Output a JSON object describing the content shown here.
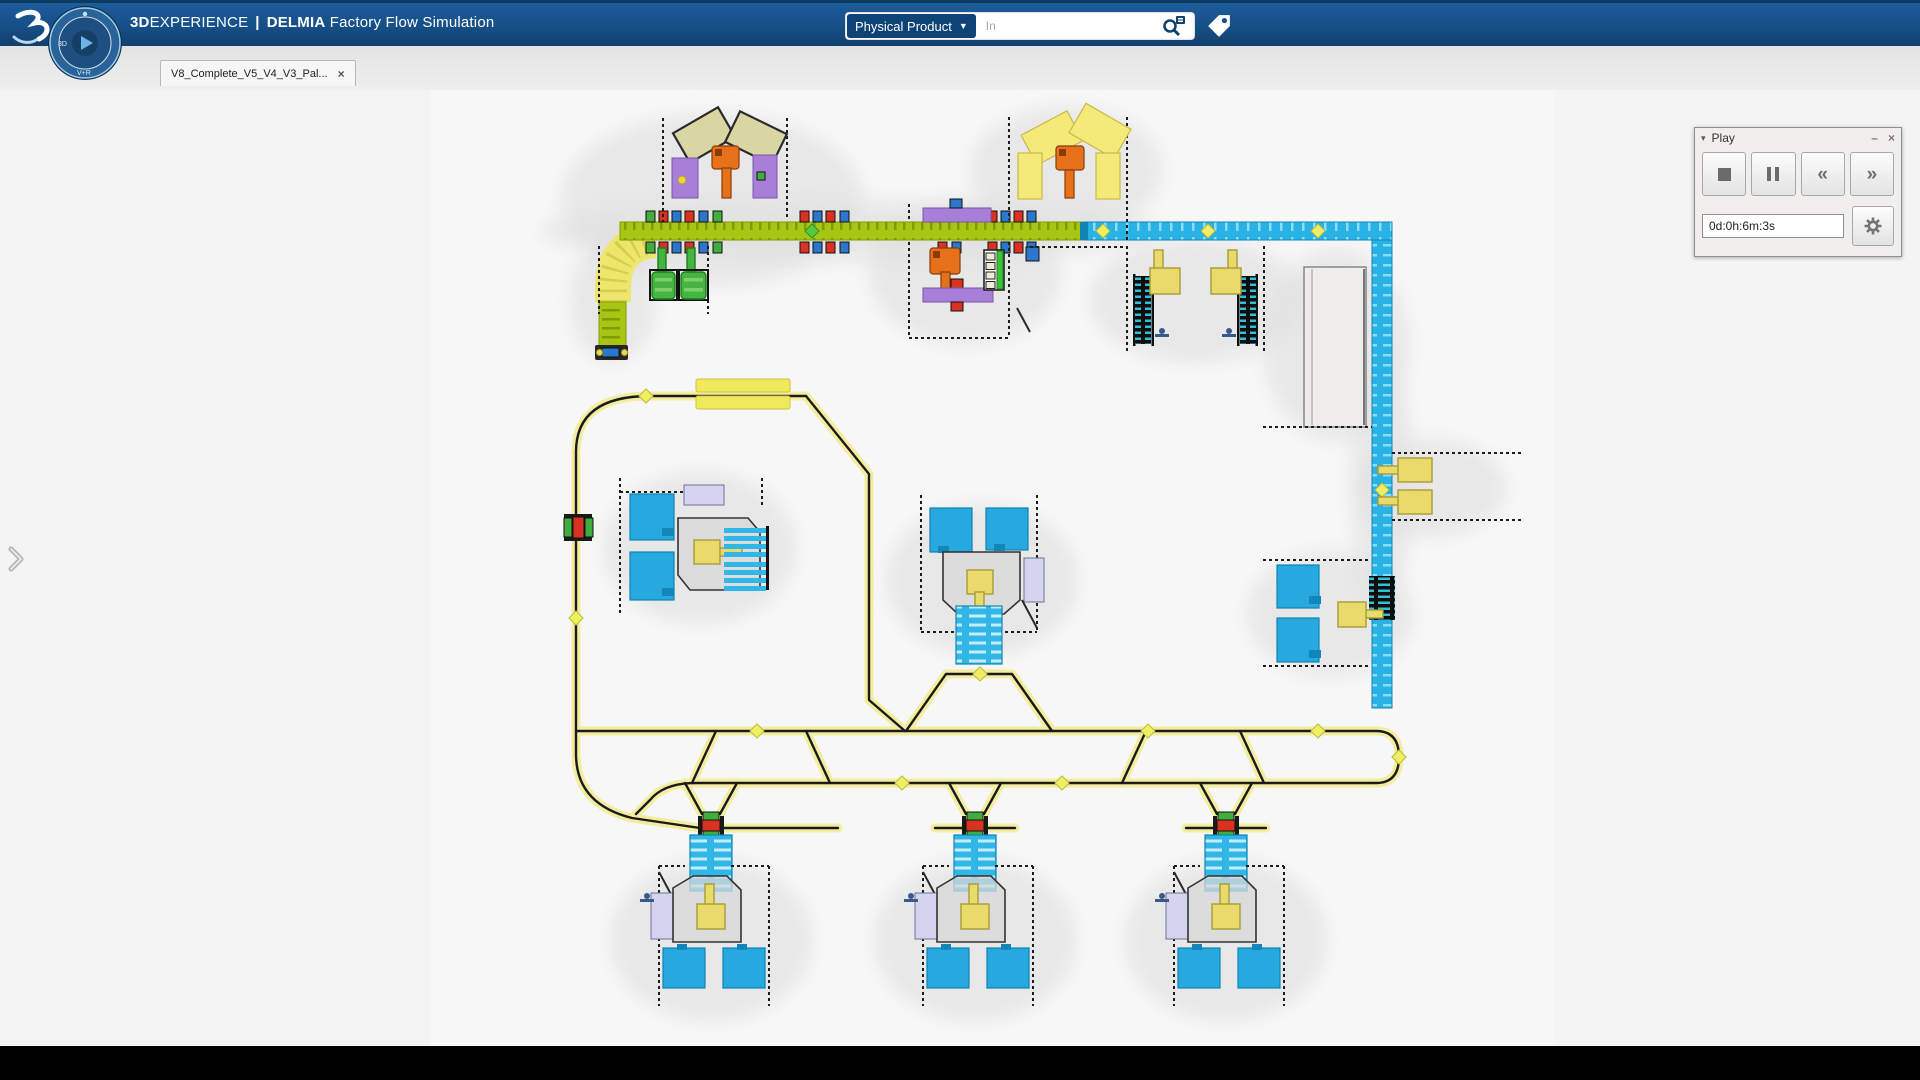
{
  "colors": {
    "topbar_blue": "#164f87",
    "chip_navy": "#0d4377",
    "strip_bg": "#e3e3e3",
    "canvas_bg": "#f7f7f7",
    "panel_bg": "#f1efed",
    "black_bar": "#000000",
    "lime": "#a7c613",
    "lime_dark": "#7f9c02",
    "belt_yellow": "#ece66c",
    "cyan": "#29b2e6",
    "cyan_light": "#8edcf6",
    "machine_cyan": "#27a9e0",
    "pallet_cyan": "#31b6e8",
    "pallet_slat": "#c4ecfb",
    "purple": "#a77fd8",
    "lavender": "#d4d4ef",
    "khaki": "#d9d6a4",
    "orange": "#e7711b",
    "robot_yellow": "#e9da6c",
    "item_red": "#da3220",
    "item_green": "#3fae3c",
    "item_blue": "#2b77cb",
    "rack_green": "#3fc23a",
    "diamond_yellow": "#f0ee62",
    "path_glow": "#f3eda0",
    "teal_stripe": "#2fc0d8",
    "worker_blue": "#3a5a8c"
  },
  "topbar": {
    "title": {
      "brand_bold": "3D",
      "brand_regular": "EXPERIENCE",
      "divider": "|",
      "app_bold": "DELMIA",
      "app_regular": "Factory Flow Simulation"
    },
    "compass": {
      "left": "3D",
      "bottom": "V+R"
    },
    "search": {
      "scope": "Physical Product",
      "caret": "▼",
      "placeholder": "In"
    },
    "icons": {
      "logo": "dassault-3ds-logo",
      "magnifier": "search-magnifier",
      "tag": "tag-label",
      "compass": "3dexperience-compass"
    }
  },
  "tabbar": {
    "active_tab": "V8_Complete_V5_V4_V3_Pal...",
    "close_glyph": "×"
  },
  "viewport": {
    "expander_icon": "chevron-right"
  },
  "play_panel": {
    "collapse_glyph": "▾",
    "title": "Play",
    "minimize_glyph": "–",
    "close_glyph": "×",
    "transport": [
      {
        "name": "stop"
      },
      {
        "name": "pause"
      },
      {
        "name": "rewind",
        "glyph": "«"
      },
      {
        "name": "fast-forward",
        "glyph": "»"
      }
    ],
    "time_field": {
      "value": "0d:0h:6m:3s"
    },
    "settings_icon": "gear"
  },
  "simulation_legend": {
    "conveyor_green": "inbound belt conveyor",
    "conveyor_blue": "outbound belt conveyor",
    "agv_track_yellow": "AGV guide-path network",
    "machines_blue": "processing machines",
    "robots_orange": "handling robots (inbound cells)",
    "robots_yellow": "handling robots (assembly cells)",
    "pallet_stacks_cyan": "pallet stacks",
    "workers_blue": "operators"
  }
}
